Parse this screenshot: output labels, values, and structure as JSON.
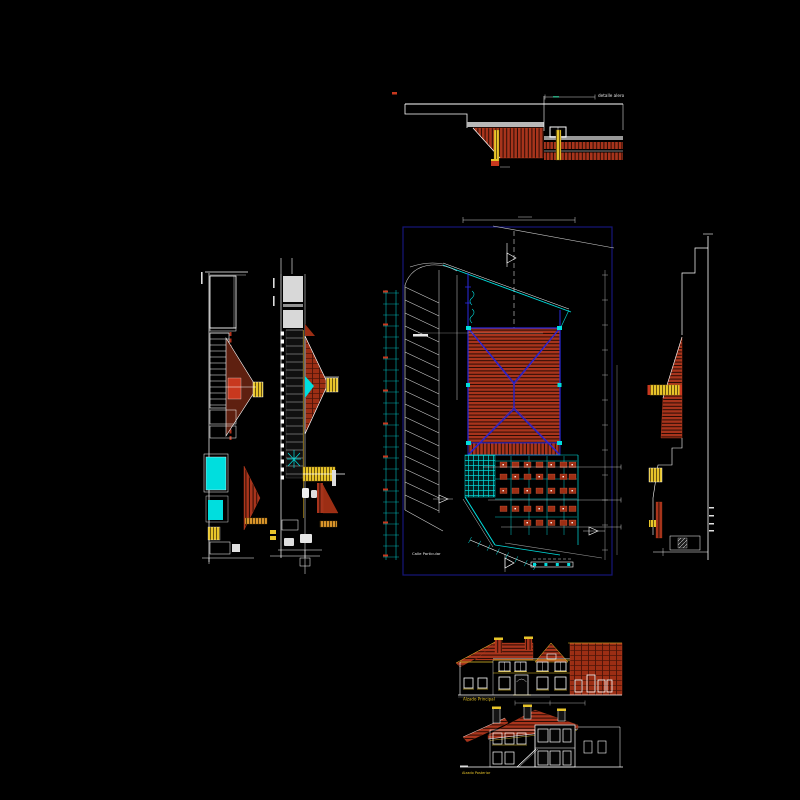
{
  "canvas": {
    "width": 800,
    "height": 800,
    "background": "#000000"
  },
  "palette": {
    "roof_red": "#a8341c",
    "roof_dark": "#2a0c04",
    "red_bright": "#c8381e",
    "brick": "#9c2e14",
    "brick_dark": "#4a1408",
    "blue_border": "#16167a",
    "blue_hip": "#2222cc",
    "blue_wall": "#2a2ae0",
    "cyan": "#00dede",
    "yellow": "#e8c52a",
    "yellow_dark": "#6b5410",
    "orange": "#d9952b",
    "green_tick": "#2aa07a",
    "white": "#ffffff",
    "gray": "#a8a8a8"
  },
  "drawings": {
    "eave_detail": {
      "label": "detalle alero"
    },
    "site_plan": {
      "street_label": "Calle Particular"
    },
    "front_elevation": {
      "label": "Alzado Principal"
    },
    "rear_elevation": {
      "label": "Alzado Posterior"
    }
  }
}
